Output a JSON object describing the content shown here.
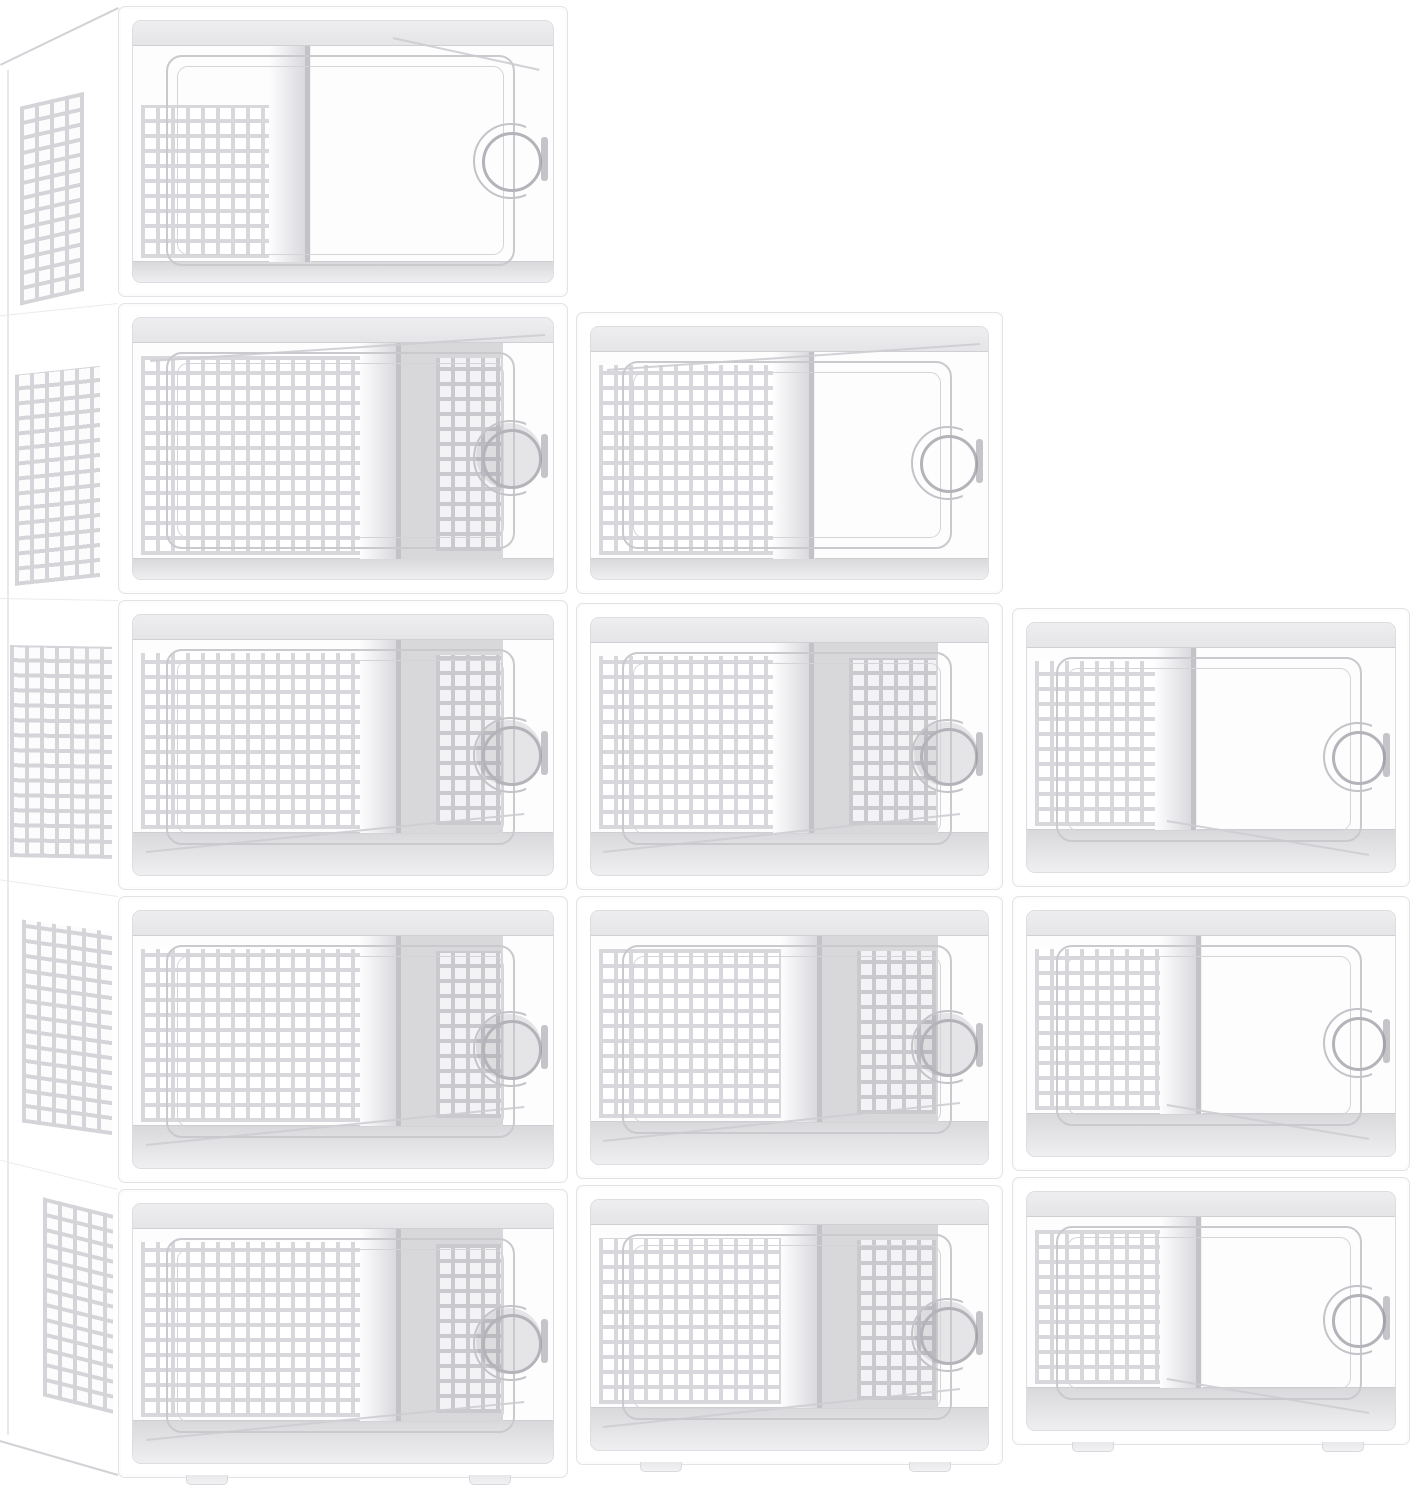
{
  "image_type": "product photograph (3D render), no visible text",
  "product": {
    "name": "stackable clear plastic shoe storage boxes",
    "visible_box_count": 12,
    "arrangement": "stair-step stack: 5 boxes left column, 4 middle column, 3 right column",
    "box_features": [
      "white plastic frame",
      "transparent drop-front door",
      "circular pull handle with crescent cutout",
      "side latch",
      "perforated square-hole ventilation panels",
      "stacking feet"
    ]
  },
  "canvas": {
    "width": 1415,
    "height": 1500,
    "background": "#ffffff"
  },
  "colors": {
    "frame": "#ffffff",
    "frame_line": "#e3e3e7",
    "inner_line": "#dddde1",
    "web": "#d8d8dc",
    "web_side": "#d5d5d9",
    "web_rear": "#c9c9ce",
    "hole": "#ffffff",
    "hole_rear": "#f3f3f5",
    "band_hi": "#eeeef0",
    "band_lo": "#e5e5e8",
    "floor_hi": "#d9d9dc",
    "floor_lo": "#efeff1",
    "hairline": "#cdcdd2",
    "divider": "#c2c2c7",
    "door_line": "#c9c9ce",
    "handle_ring": "#b3b3b9",
    "latch": "#96969c",
    "shade": "#dadade",
    "rear_zone": "#d8d8db"
  },
  "stack": {
    "side_strip": {
      "x": 0,
      "w": 118,
      "back_edge_x": 7,
      "top_diag": {
        "x1": 0,
        "y1": 64,
        "x2": 118,
        "y2": 7
      },
      "bottom_diag": {
        "x1": 0,
        "y1": 1440,
        "x2": 118,
        "y2": 1474
      },
      "rows": [
        {
          "y": 6,
          "h": 291,
          "angle": -13,
          "t": 78,
          "b": 14,
          "x1": 20,
          "x2": 84
        },
        {
          "y": 303,
          "h": 291,
          "angle": -6,
          "t": 60,
          "b": 20,
          "x1": 15,
          "x2": 100
        },
        {
          "y": 600,
          "h": 290,
          "angle": 1,
          "t": 46,
          "b": 32,
          "x1": 10,
          "x2": 112
        },
        {
          "y": 896,
          "h": 287,
          "angle": 8,
          "t": 36,
          "b": 48,
          "x1": 22,
          "x2": 112
        },
        {
          "y": 1189,
          "h": 289,
          "angle": 14,
          "t": 26,
          "b": 64,
          "x1": 43,
          "x2": 113
        }
      ]
    },
    "columns": [
      {
        "id": "left",
        "x": 118,
        "w": 450,
        "boxes": [
          {
            "row": 1,
            "y": 6,
            "h": 291,
            "divider": 0.41,
            "rear": false,
            "diag": "top-down",
            "grid_top": 84,
            "door_bot": 20
          },
          {
            "row": 2,
            "y": 303,
            "h": 291,
            "divider": 0.625,
            "rear": true,
            "diag": "top-up"
          },
          {
            "row": 3,
            "y": 600,
            "h": 290,
            "divider": 0.625,
            "rear": true,
            "diag": "bot-up"
          },
          {
            "row": 4,
            "y": 896,
            "h": 287,
            "divider": 0.625,
            "rear": true,
            "diag": "bot-up"
          },
          {
            "row": 5,
            "y": 1189,
            "h": 289,
            "divider": 0.625,
            "rear": true,
            "diag": "bot-up",
            "feet": true
          }
        ]
      },
      {
        "id": "middle",
        "x": 576,
        "w": 427,
        "boxes": [
          {
            "row": 2,
            "y": 312,
            "h": 282,
            "divider": 0.55,
            "rear": false,
            "diag": "top-up"
          },
          {
            "row": 3,
            "y": 603,
            "h": 287,
            "divider": 0.55,
            "rear": true,
            "diag": "bot-up"
          },
          {
            "row": 4,
            "y": 896,
            "h": 283,
            "divider": 0.57,
            "rear": true,
            "diag": "bot-up"
          },
          {
            "row": 5,
            "y": 1185,
            "h": 280,
            "divider": 0.57,
            "rear": true,
            "diag": "bot-up",
            "feet": true
          }
        ]
      },
      {
        "id": "right",
        "x": 1012,
        "w": 398,
        "boxes": [
          {
            "row": 3,
            "y": 608,
            "h": 279,
            "divider": 0.445,
            "rear": false,
            "diag": "bot-down"
          },
          {
            "row": 4,
            "y": 896,
            "h": 275,
            "divider": 0.46,
            "rear": false,
            "diag": "bot-down"
          },
          {
            "row": 5,
            "y": 1177,
            "h": 268,
            "divider": 0.46,
            "rear": false,
            "diag": "bot-down",
            "feet": true
          }
        ]
      }
    ]
  }
}
